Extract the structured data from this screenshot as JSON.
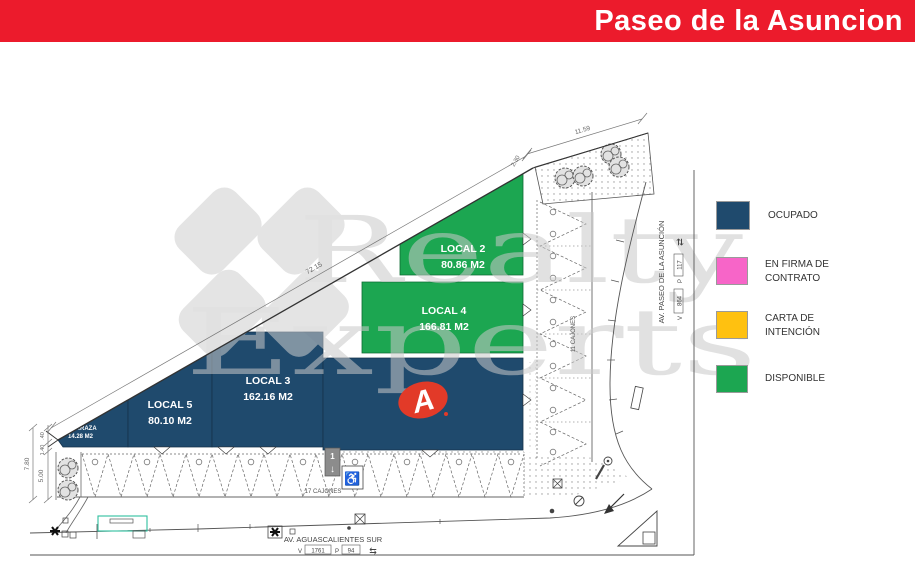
{
  "header": {
    "title": "Paseo de la Asuncion",
    "bg_color": "#EC1B2C"
  },
  "watermark": {
    "line1": "Realty",
    "line2": "Experts",
    "color": "#c9c9c9"
  },
  "legend": {
    "items": [
      {
        "label1": "OCUPADO",
        "label2": "",
        "color": "#1F4A6D"
      },
      {
        "label1": "EN FIRMA DE",
        "label2": "CONTRATO",
        "color": "#F765C8"
      },
      {
        "label1": "CARTA DE",
        "label2": "INTENCIÓN",
        "color": "#FFC110"
      },
      {
        "label1": "DISPONIBLE",
        "label2": "",
        "color": "#1CA651"
      }
    ]
  },
  "plan": {
    "locals": [
      {
        "name": "LOCAL 2",
        "area": "80.86 M2",
        "status": "DISPONIBLE",
        "color": "#1CA651"
      },
      {
        "name": "LOCAL 4",
        "area": "166.81 M2",
        "status": "DISPONIBLE",
        "color": "#1CA651"
      },
      {
        "name": "LOCAL 3",
        "area": "162.16 M2",
        "status": "OCUPADO",
        "color": "#1F4A6D"
      },
      {
        "name": "LOCAL 5",
        "area": "80.10 M2",
        "status": "OCUPADO",
        "color": "#1F4A6D"
      },
      {
        "name": "TERRAZA",
        "area": "14.28 M2",
        "status": "OCUPADO",
        "color": "#1F4A6D"
      }
    ],
    "anchor": {
      "logo_letter": "A",
      "color": "#1F4A6D",
      "logo_color": "#E23A28"
    },
    "dimensions": {
      "diagonal": "72.15",
      "top": "11.59",
      "top_small": "2.30",
      "left_total": "7.80",
      "left_inner": "5.00",
      "left_small1": ".40",
      "left_small2": "1.40"
    },
    "parking": {
      "front_label": "17 CAJONES",
      "side_label": "11 CAJONES"
    },
    "streets": {
      "south": "AV. AGUASCALIENTES SUR",
      "east": "AV. PASEO DE LA ASUNCIÓN"
    },
    "refs": {
      "v_label": "V",
      "p_label": "P",
      "south_v": "1761",
      "south_p": "94",
      "east_v": "864",
      "east_p": "117"
    },
    "entrance_number": "1"
  }
}
